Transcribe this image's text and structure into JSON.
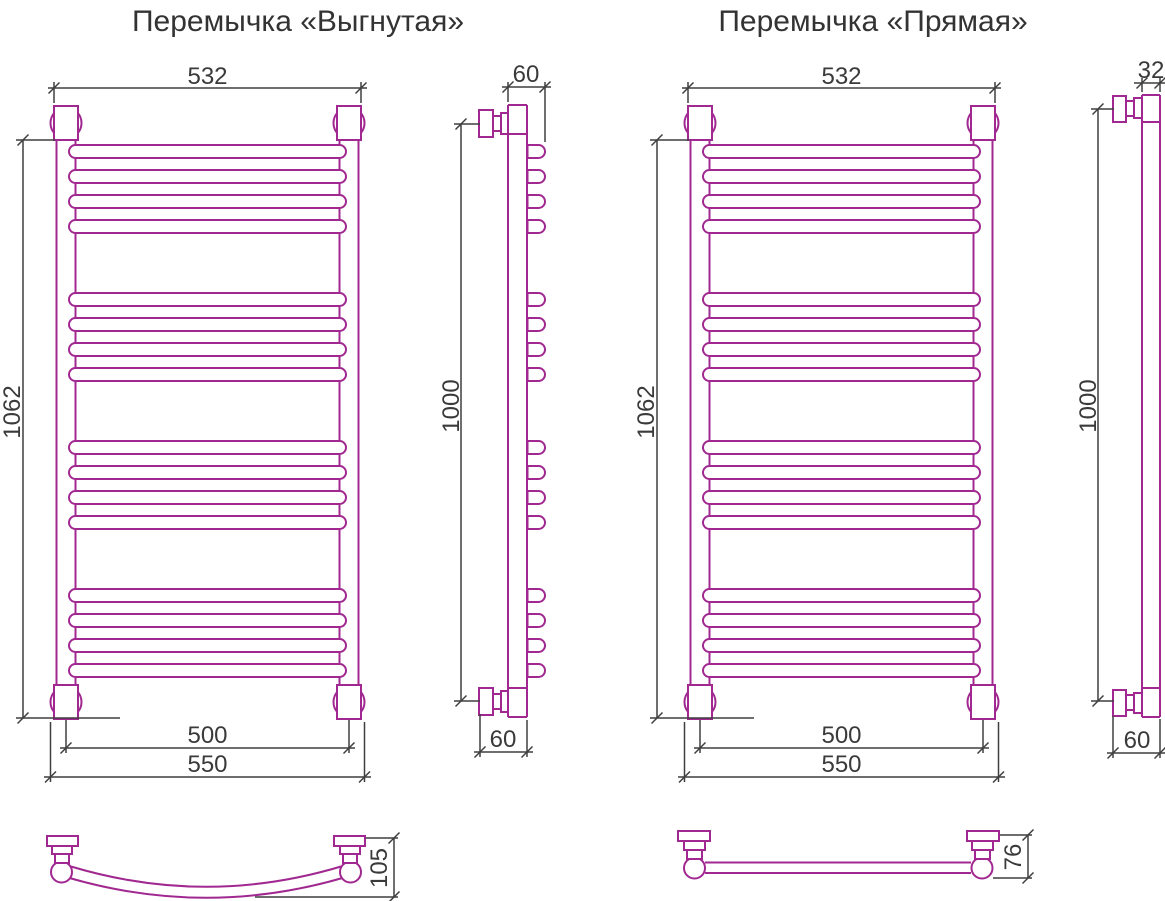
{
  "colors": {
    "product_outline": "#a02890",
    "dimension_lines": "#3f3f3f",
    "text": "#3a3a3a"
  },
  "left_drawing": {
    "title": "Перемычка «Выгнутая»",
    "front_view": {
      "top_width": "532",
      "height": "1062",
      "mount_centers_width": "500",
      "overall_width": "550"
    },
    "side_view": {
      "top_depth": "60",
      "mount_height": "1000",
      "bottom_depth": "60"
    },
    "crossbar_detail": {
      "bow_depth": "105"
    }
  },
  "right_drawing": {
    "title": "Перемычка «Прямая»",
    "front_view": {
      "top_width": "532",
      "height": "1062",
      "mount_centers_width": "500",
      "overall_width": "550"
    },
    "side_view": {
      "top_width": "32",
      "mount_height": "1000",
      "bottom_depth": "60"
    },
    "crossbar_detail": {
      "depth": "76"
    }
  }
}
